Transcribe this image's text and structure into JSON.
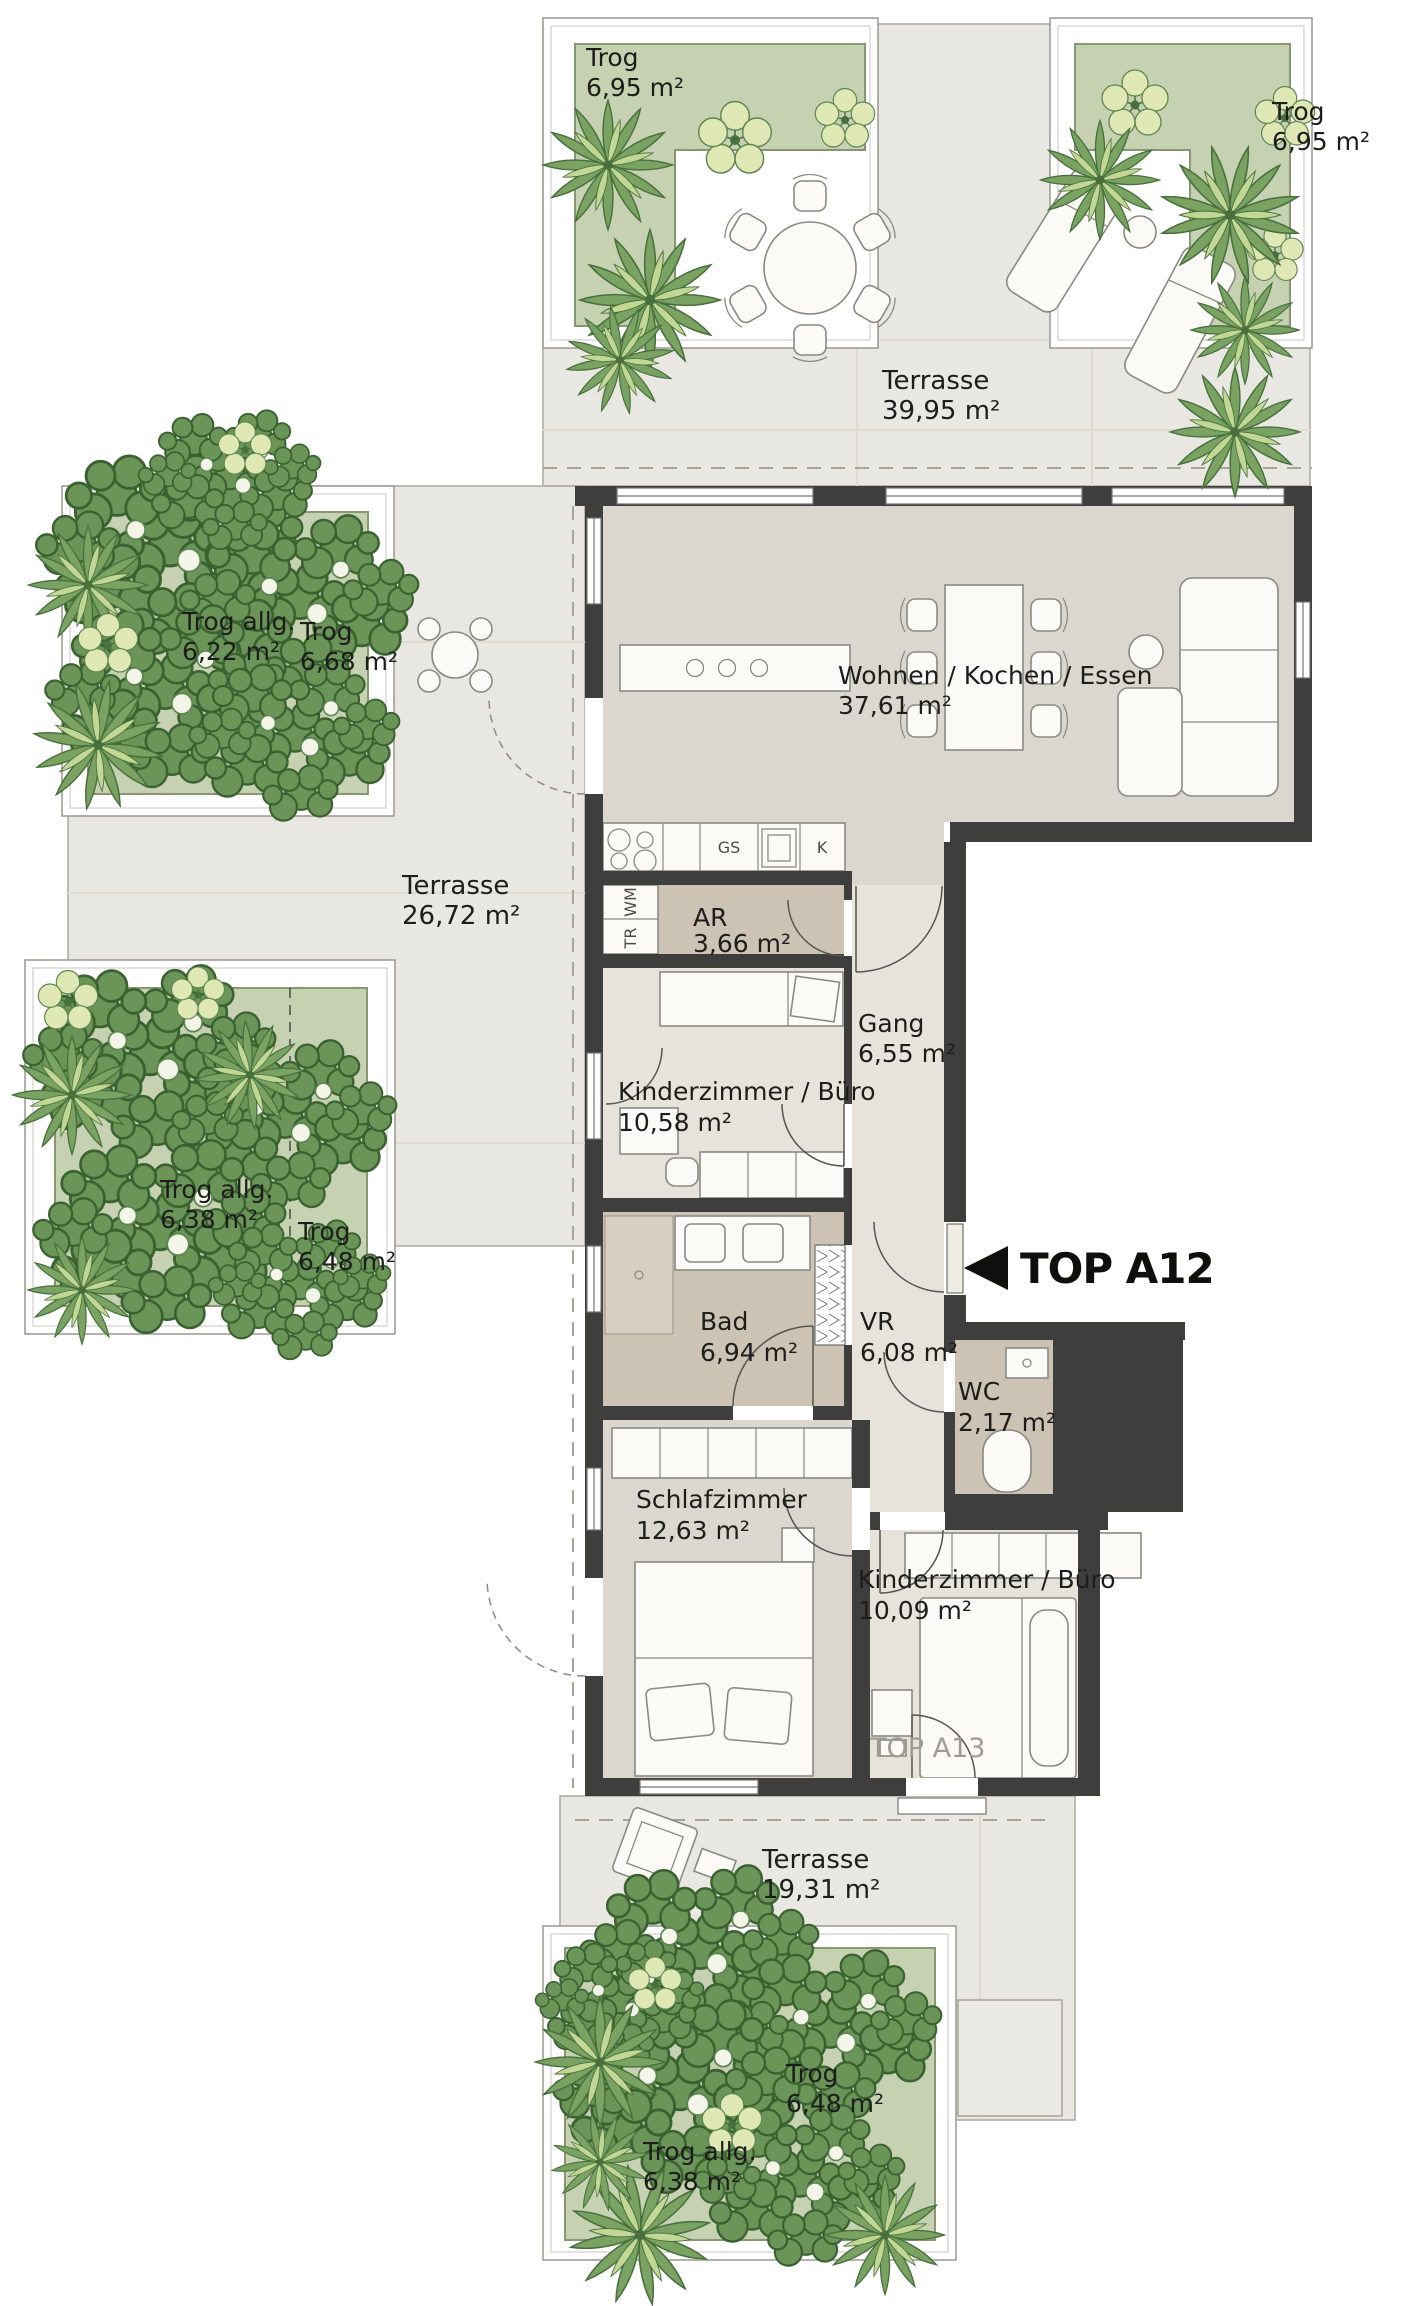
{
  "unit": {
    "arrow": "◀",
    "label": "TOP A12",
    "neighbor_label": "TOP A13"
  },
  "terraces": {
    "top": {
      "name": "Terrasse",
      "area": "39,95 m²"
    },
    "left": {
      "name": "Terrasse",
      "area": "26,72 m²"
    },
    "bottom": {
      "name": "Terrasse",
      "area": "19,31 m²"
    }
  },
  "rooms": {
    "living": {
      "name": "Wohnen / Kochen / Essen",
      "area": "37,61 m²"
    },
    "ar": {
      "name": "AR",
      "area": "3,66 m²"
    },
    "gang": {
      "name": "Gang",
      "area": "6,55 m²"
    },
    "child1": {
      "name": "Kinderzimmer / Büro",
      "area": "10,58 m²"
    },
    "bad": {
      "name": "Bad",
      "area": "6,94 m²"
    },
    "vr": {
      "name": "VR",
      "area": "6,08 m²"
    },
    "wc": {
      "name": "WC",
      "area": "2,17 m²"
    },
    "bedroom": {
      "name": "Schlafzimmer",
      "area": "12,63 m²"
    },
    "child2": {
      "name": "Kinderzimmer / Büro",
      "area": "10,09 m²"
    }
  },
  "troughs": {
    "top_left": {
      "name": "Trog",
      "area": "6,95 m²"
    },
    "top_right": {
      "name": "Trog",
      "area": "6,95 m²"
    },
    "left_upper_shared": {
      "name": "Trog allg.",
      "area": "6,22 m²"
    },
    "left_upper": {
      "name": "Trog",
      "area": "6,68 m²"
    },
    "left_lower_shared": {
      "name": "Trog allg.",
      "area": "6,38 m²"
    },
    "left_lower": {
      "name": "Trog",
      "area": "6,48 m²"
    },
    "bottom": {
      "name": "Trog",
      "area": "6,48 m²"
    },
    "bottom_shared": {
      "name": "Trog allg.",
      "area": "6,38 m²"
    }
  },
  "appliances": {
    "washing_machine": "WM",
    "dryer": "TR",
    "dishwasher": "GS",
    "fridge": "K"
  },
  "colors": {
    "wall": "#3e3e3c",
    "room_floor": "#dbd7ce",
    "hall_floor": "#e7e3da",
    "wet_floor": "#cdc3b4",
    "terrace_floor": "#e9e7e1",
    "trough": "#c5d1b0",
    "plant_dark": "#6b9459",
    "plant_light": "#dfe8b4",
    "text": "#1d1d1b"
  }
}
